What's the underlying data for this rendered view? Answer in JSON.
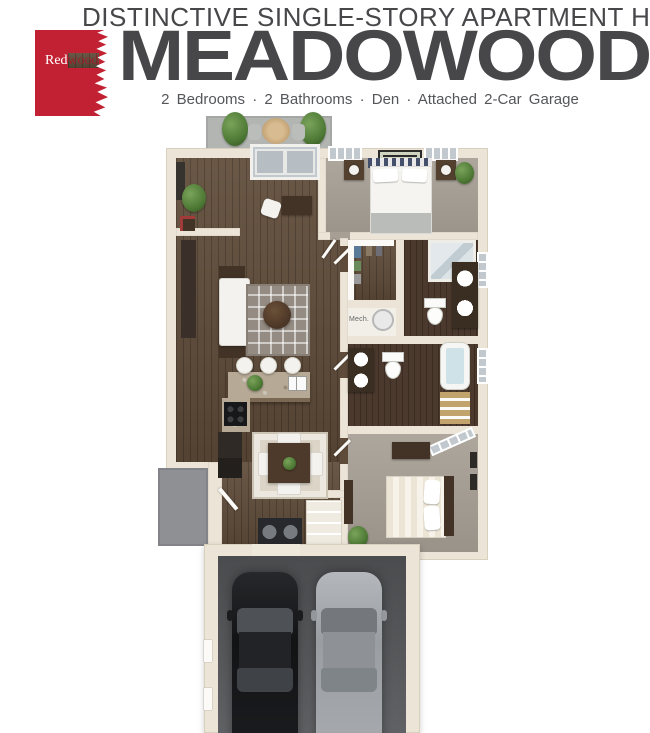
{
  "header": {
    "tagline": "DISTINCTIVE SINGLE-STORY APARTMENT HOMES",
    "logo": {
      "red": "Red",
      "wood": "wood"
    },
    "plan_name": "MEADOWOOD",
    "features": "2 Bedrooms  ·  2 Bathrooms  ·  Den  ·  Attached 2-Car Garage"
  },
  "floorplan": {
    "mech_label": "Mech."
  },
  "colors": {
    "brand-red": "#c22133",
    "brand-red-dark": "#9d1f2c",
    "heading": "#47474a",
    "subtext": "#55565a",
    "wall": "#ece5d7",
    "wall-edge": "#d8cfbc",
    "wood": "#5f4b39",
    "wood-dark": "#4a392c",
    "carpet": "#a79f94",
    "mech-floor": "#f1efe8",
    "garage-floor": "#57595c",
    "patio": "#b2b5b2",
    "stoop": "#8e9093",
    "rug-living": "#948c83",
    "rug-dining": "#dcd5c7",
    "granite": "#b6aa96",
    "dark-furn": "#423326",
    "white-furn": "#f4f2ee",
    "glass": "#c2c9ce",
    "plant": "#4e7a36",
    "car-black": "#1a1c1f",
    "car-silver": "#a3a7ab"
  }
}
